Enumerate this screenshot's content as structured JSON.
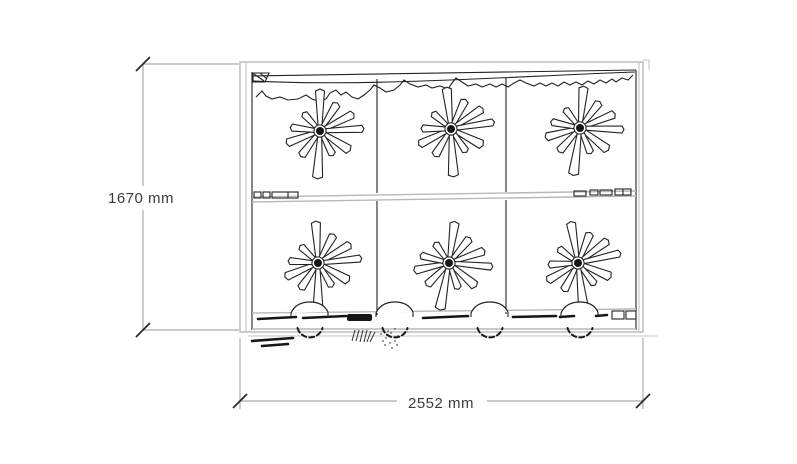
{
  "drawing": {
    "type": "cabinet-front-elevation",
    "dimensions": {
      "height": {
        "label": "1670 mm",
        "value": 1670,
        "unit": "mm"
      },
      "width": {
        "label": "2552 mm",
        "value": 2552,
        "unit": "mm"
      }
    },
    "structure": {
      "rows": 2,
      "columns": 3,
      "panels": 6,
      "casters": 4
    },
    "colors": {
      "background": "#ffffff",
      "line_dark": "#222222",
      "line_gray": "#b8b8b8",
      "label_text": "#3c3c3c"
    },
    "fans": {
      "centers": [
        [
          320,
          131
        ],
        [
          451,
          129
        ],
        [
          580,
          128
        ],
        [
          318,
          263
        ],
        [
          449,
          263
        ],
        [
          578,
          263
        ]
      ],
      "rotations": [
        0,
        6,
        -5,
        3,
        -8,
        10
      ],
      "blades": [
        [
          90,
          40,
          9
        ],
        [
          58,
          31,
          8
        ],
        [
          27,
          36,
          8
        ],
        [
          3,
          42,
          7
        ],
        [
          -33,
          34,
          9
        ],
        [
          -62,
          26,
          7
        ],
        [
          -93,
          46,
          10
        ],
        [
          -127,
          30,
          8
        ],
        [
          -160,
          34,
          8
        ],
        [
          173,
          28,
          7
        ],
        [
          133,
          23,
          7
        ]
      ],
      "hub_radius": 4
    },
    "casters": {
      "centers_x": [
        310,
        395,
        490,
        580
      ],
      "center_y": 325,
      "radius": 13,
      "rail_y": 313
    }
  }
}
